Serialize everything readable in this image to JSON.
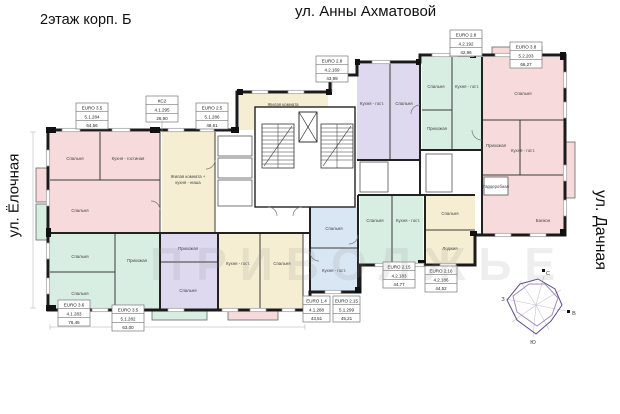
{
  "title": "2этаж корп. Б",
  "streets": {
    "top": "ул. Анны Ахматовой",
    "left": "ул. Ёлочная",
    "right": "ул. Дачная"
  },
  "compass": {
    "north": "С",
    "south": "Ю",
    "west": "З",
    "east": "В"
  },
  "watermark": {
    "text": "ПРИВОЛЖЬЕ"
  },
  "palette": {
    "pink": "#f7dadb",
    "mint": "#d9eee3",
    "blue": "#d9e6f4",
    "lavender": "#ded9ef",
    "cream": "#f6eed3",
    "wall": "#1b1b1b"
  },
  "labels": {
    "bedroom": "Спальня",
    "kitchen_living": "Кухня - гостиная",
    "kitchen_living_short": "Кухня - гост.",
    "hall": "Прихожая",
    "wardrobe": "Гардеробная",
    "balcony": "Балкон",
    "loggia": "Лоджия",
    "living_room": "Жилая комната",
    "living_niche_1": "Жилая комната +",
    "living_niche_2": "кухня - ниша"
  },
  "apartments": [
    {
      "type": "EURO 3.5",
      "number": "5.1.284",
      "area": "64,56"
    },
    {
      "type": "КС2",
      "number": "4.1.295",
      "area": "26,90"
    },
    {
      "type": "EURO 2.5",
      "number": "5.1.286",
      "area": "48,61"
    },
    {
      "type": "EURO 2.8",
      "number": "4.2.169",
      "area": "43,99"
    },
    {
      "type": "EURO 2.8",
      "number": "4.2.192",
      "area": "42,96"
    },
    {
      "type": "EURO 3.8",
      "number": "5.2.203",
      "area": "66,27"
    },
    {
      "type": "EURO 2.15",
      "number": "4.2.183",
      "area": "44,77"
    },
    {
      "type": "EURO 2.16",
      "number": "4.2.186",
      "area": "44,52"
    },
    {
      "type": "EURO 3.6",
      "number": "4.1.283",
      "area": "76,45"
    },
    {
      "type": "EURO 3.5",
      "number": "5.1.282",
      "area": "63,00"
    },
    {
      "type": "EURO 1.4",
      "number": "4.1.288",
      "area": "43,51"
    },
    {
      "type": "EURO 2.15",
      "number": "5.1.299",
      "area": "45,21"
    }
  ]
}
